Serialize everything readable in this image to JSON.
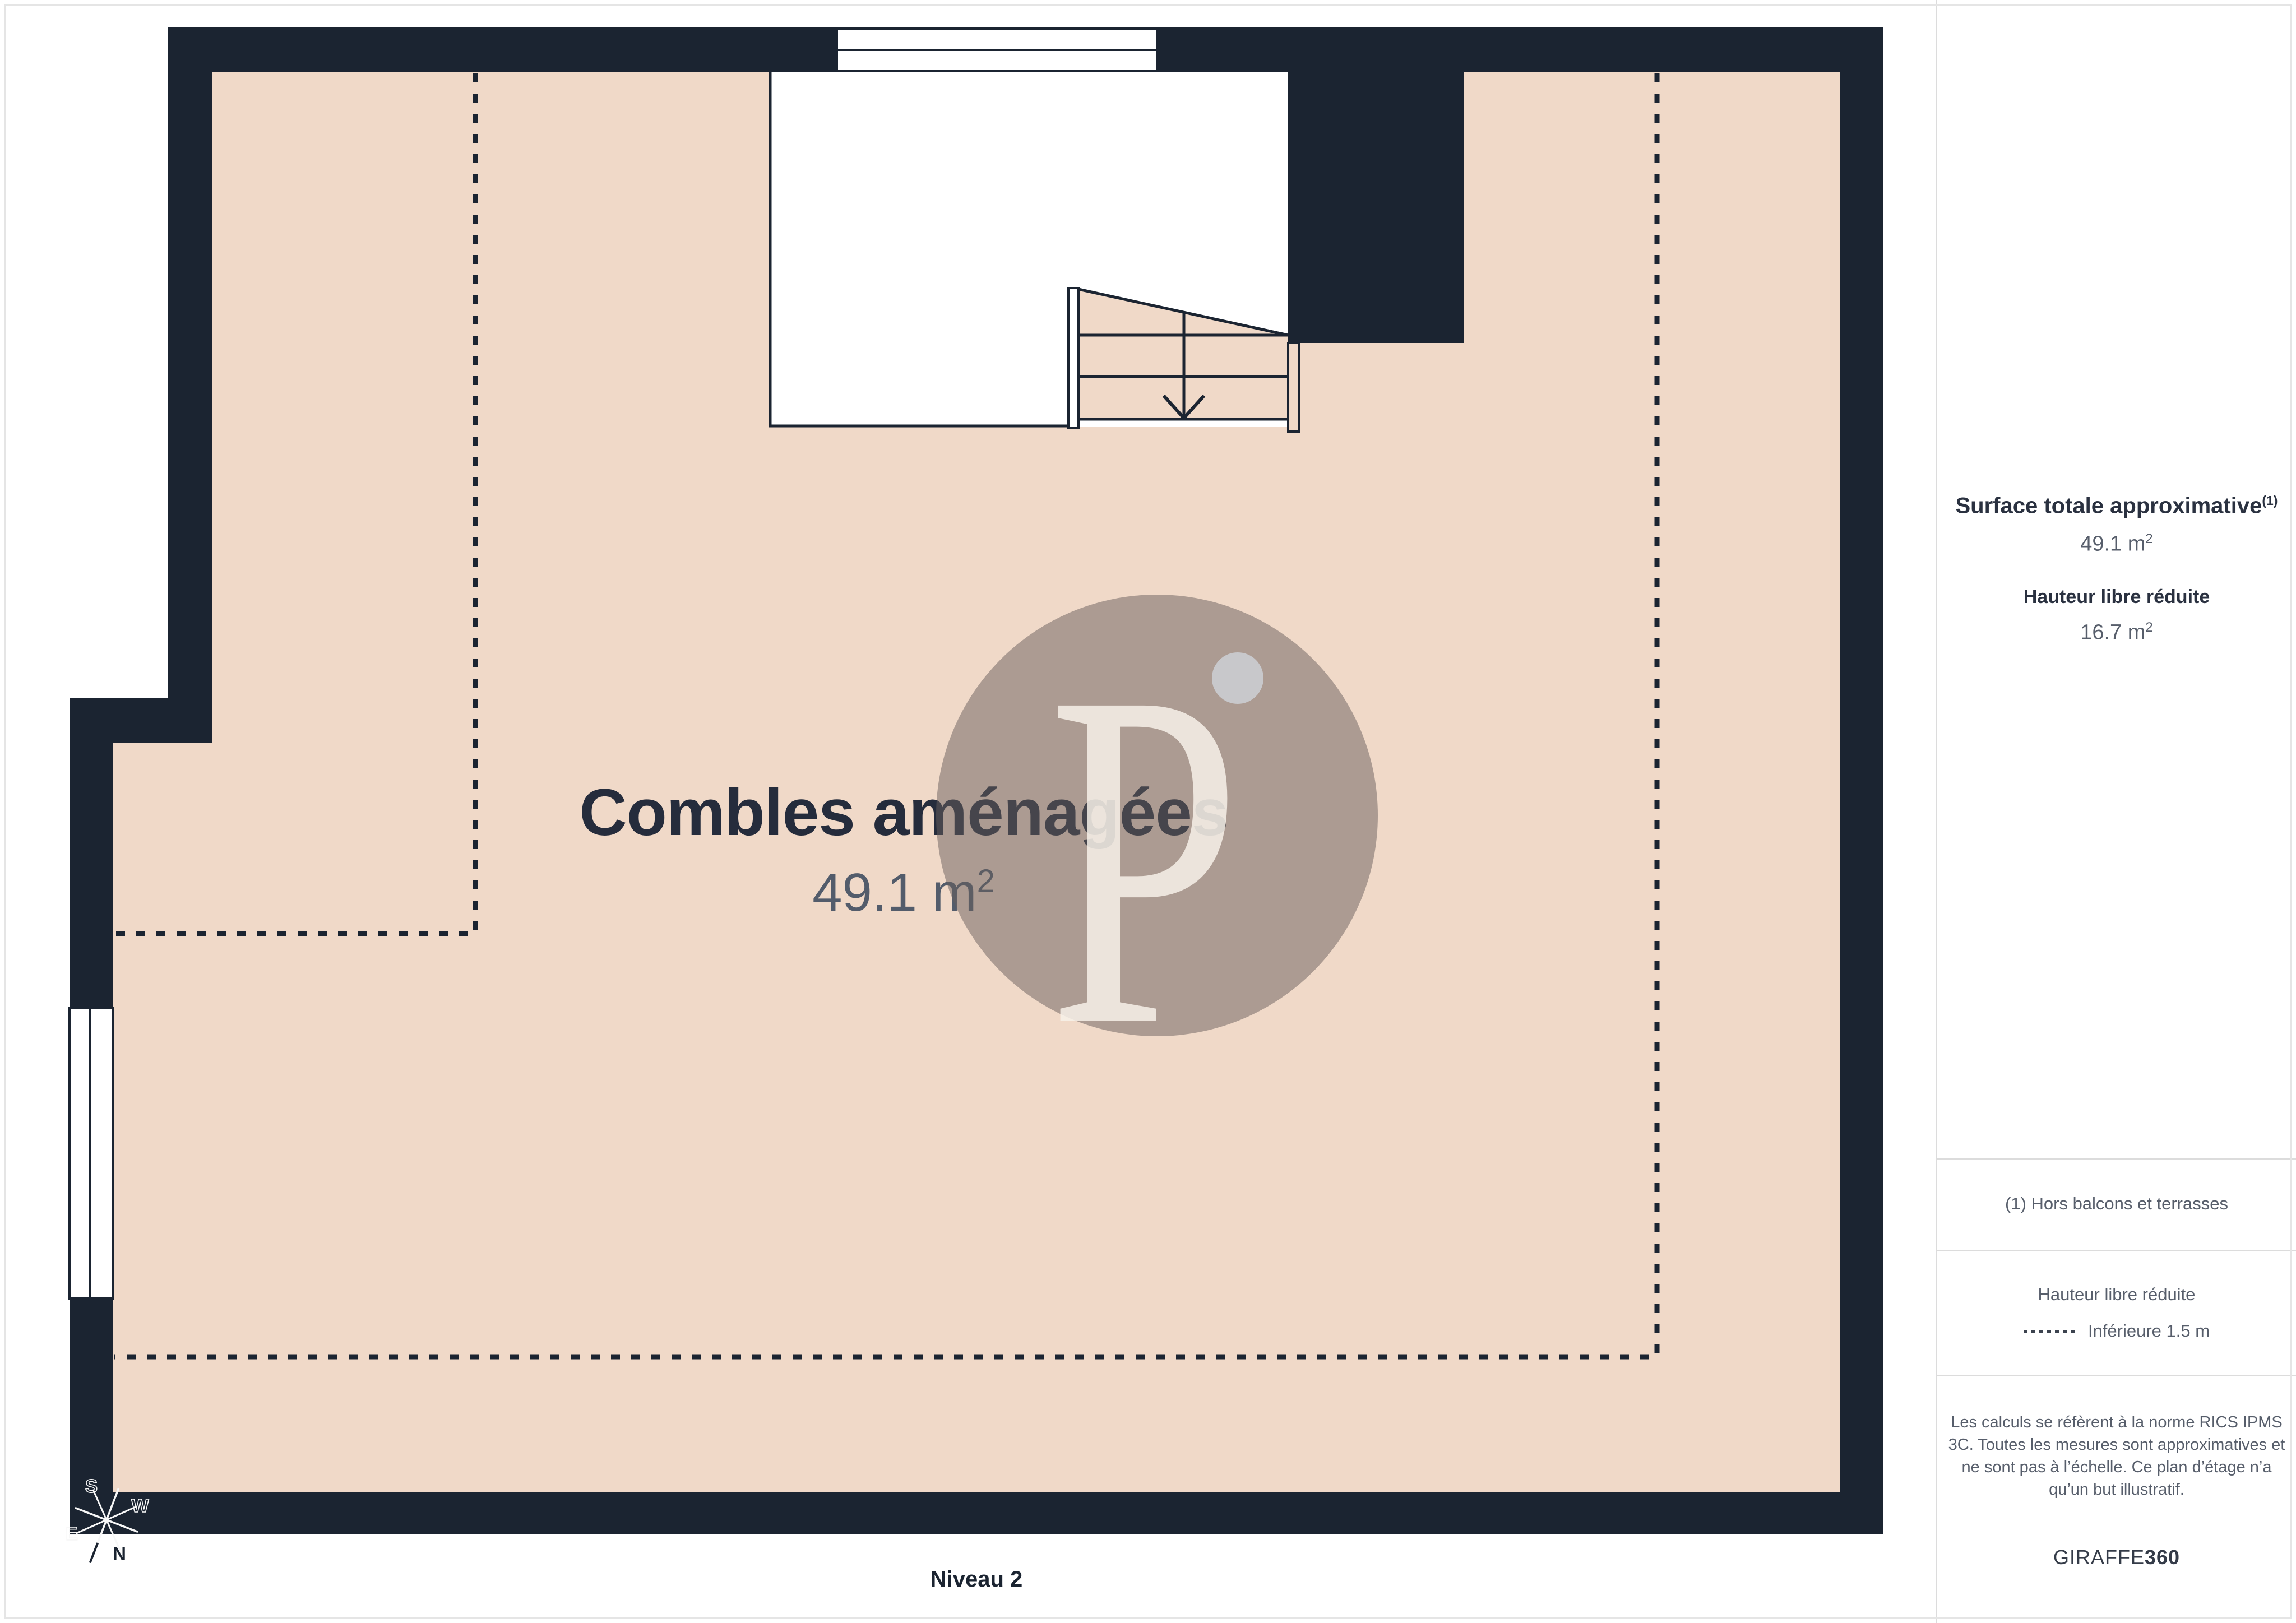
{
  "page": {
    "level_label": "Niveau 2"
  },
  "room": {
    "name": "Combles aménagées",
    "area_value": "49.1 m",
    "area_sup": "2"
  },
  "compass": {
    "n": "N",
    "s": "S",
    "e": "E",
    "w": "W"
  },
  "watermark": {
    "letter": "P"
  },
  "sidebar": {
    "surface_title": "Surface totale approximative",
    "surface_title_sup": "(1)",
    "surface_value": "49.1 m",
    "sup2": "2",
    "reduced_title": "Hauteur libre réduite",
    "reduced_value": "16.7 m",
    "note": "(1) Hors balcons et terrasses",
    "legend_title": "Hauteur libre réduite",
    "legend_item": "Inférieure 1.5 m",
    "disclaimer": "Les calculs se réfèrent à la norme RICS IPMS 3C. Toutes les mesures sont approximatives et ne sont pas à l’échelle. Ce plan d’étage n’a qu’un but illustratif.",
    "brand_name": "GIRAFFE",
    "brand_suffix": "360"
  },
  "colors": {
    "wall": "#1B2431",
    "floor": "#F0D9C8",
    "navy_text": "#262E3E",
    "muted_text": "#575E6B",
    "separator": "#DCDCDC",
    "watermark_circle": "rgba(104,94,92,0.5)",
    "watermark_letter": "rgba(247,241,233,0.85)",
    "watermark_dot": "rgba(201,202,207,0.95)"
  }
}
